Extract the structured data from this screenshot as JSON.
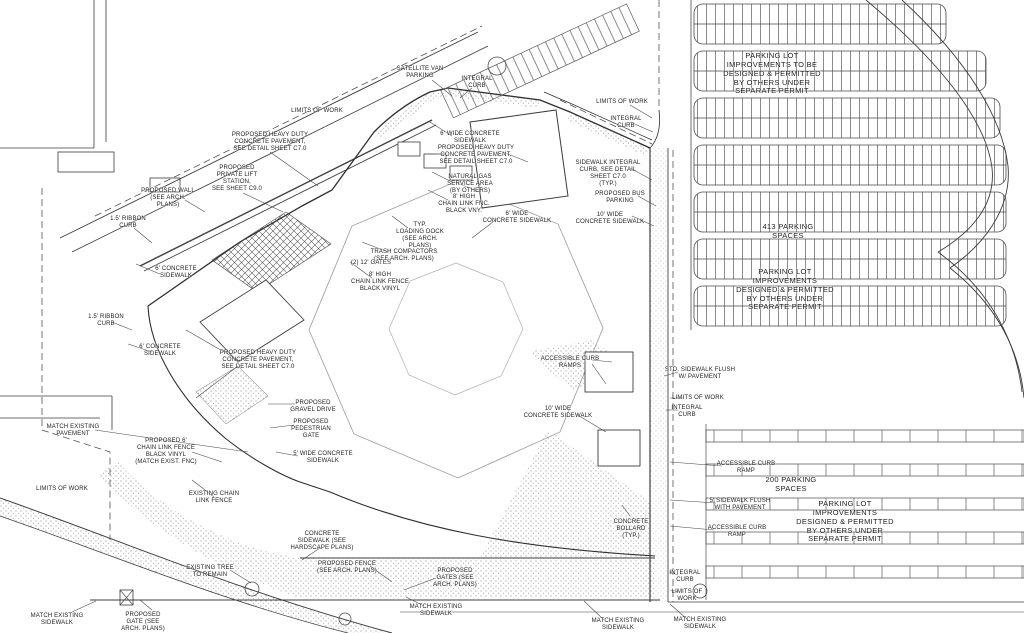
{
  "meta": {
    "drawing_type": "Civil engineering site plan (scanned line drawing)",
    "ink_color": "#2e2e2e",
    "paper_color": "#ffffff"
  },
  "parking": {
    "north_lot_spaces": "413 PARKING SPACES",
    "south_lot_spaces": "200 PARKING SPACES"
  },
  "labels": [
    {
      "id": "limits-of-work-top",
      "text": "LIMITS OF WORK"
    },
    {
      "id": "heavy-duty-pavement-1",
      "text": "PROPOSED HEAVY DUTY\nCONCRETE PAVEMENT,\nSEE DETAIL SHEET C7.0"
    },
    {
      "id": "private-lift-station",
      "text": "PROPOSED\nPRIVATE LIFT\nSTATION,\nSEE SHEET C9.0"
    },
    {
      "id": "proposed-wall",
      "text": "PROPOSED WALL\n(SEE ARCH.\nPLANS)"
    },
    {
      "id": "ribbon-curb-1",
      "text": "1.5' RIBBON\nCURB"
    },
    {
      "id": "concrete-sidewalk-1",
      "text": "6' CONCRETE\nSIDEWALK"
    },
    {
      "id": "ribbon-curb-2",
      "text": "1.5' RIBBON\nCURB"
    },
    {
      "id": "concrete-sidewalk-2",
      "text": "6' CONCRETE\nSIDEWALK"
    },
    {
      "id": "heavy-duty-pavement-2",
      "text": "PROPOSED HEAVY DUTY\nCONCRETE PAVEMENT,\nSEE DETAIL SHEET C7.0"
    },
    {
      "id": "match-existing-pavement",
      "text": "MATCH EXISTING\nPAVEMENT"
    },
    {
      "id": "limits-of-work-left",
      "text": "LIMITS OF WORK"
    },
    {
      "id": "chain-link-fence-6ft",
      "text": "PROPOSED 6'\nCHAIN LINK FENCE\nBLACK VINYL\n(MATCH EXIST. FNC)"
    },
    {
      "id": "existing-chain-link",
      "text": "EXISTING CHAIN\nLINK FENCE"
    },
    {
      "id": "gravel-drive",
      "text": "PROPOSED\nGRAVEL DRIVE"
    },
    {
      "id": "pedestrian-gate",
      "text": "PROPOSED\nPEDESTRIAN\nGATE"
    },
    {
      "id": "sidewalk-5-wide",
      "text": "5' WIDE CONCRETE\nSIDEWALK"
    },
    {
      "id": "existing-tree",
      "text": "EXISTING TREE\nTO REMAIN"
    },
    {
      "id": "match-existing-sidewalk-sw",
      "text": "MATCH EXISTING\nSIDEWALK"
    },
    {
      "id": "proposed-gate-sw",
      "text": "PROPOSED\nGATE (SEE\nARCH. PLANS)"
    },
    {
      "id": "concrete-sidewalk-hardscape",
      "text": "CONCRETE\nSIDEWALK (SEE\nHARDSCAPE PLANS)"
    },
    {
      "id": "proposed-fence",
      "text": "PROPOSED FENCE\n(SEE ARCH. PLANS)"
    },
    {
      "id": "proposed-gates",
      "text": "PROPOSED\nGATES (SEE\nARCH. PLANS)"
    },
    {
      "id": "match-existing-sidewalk-s1",
      "text": "MATCH EXISTING\nSIDEWALK"
    },
    {
      "id": "match-existing-sidewalk-s2",
      "text": "MATCH EXISTING\nSIDEWALK"
    },
    {
      "id": "match-existing-sidewalk-s3",
      "text": "MATCH EXISTING\nSIDEWALK"
    },
    {
      "id": "integral-curb-s",
      "text": "INTEGRAL\nCURB"
    },
    {
      "id": "limits-of-work-s",
      "text": "LIMITS OF\nWORK"
    },
    {
      "id": "satellite-van-parking",
      "text": "SATELLITE VAN\nPARKING"
    },
    {
      "id": "integral-curb-top",
      "text": "INTEGRAL\nCURB"
    },
    {
      "id": "limits-of-work-ne",
      "text": "LIMITS OF WORK"
    },
    {
      "id": "integral-curb-ne",
      "text": "INTEGRAL\nCURB"
    },
    {
      "id": "sidewalk-6-wide-n",
      "text": "6' WIDE CONCRETE\nSIDEWALK"
    },
    {
      "id": "heavy-duty-pavement-3",
      "text": "PROPOSED HEAVY DUTY\nCONCRETE PAVEMENT,\nSEE DETAIL SHEET C7.0"
    },
    {
      "id": "natural-gas-area",
      "text": "NATURAL GAS\nSERVICE AREA\n(BY OTHERS)"
    },
    {
      "id": "chain-link-8-n",
      "text": "8' HIGH\nCHAIN LINK FNC.\nBLACK VNY."
    },
    {
      "id": "sidewalk-6-wide-e",
      "text": "6' WIDE\nCONCRETE SIDEWALK"
    },
    {
      "id": "loading-dock",
      "text": "TYP.\nLOADING DOCK\n(SEE ARCH.\nPLANS)"
    },
    {
      "id": "trash-compactors",
      "text": "TRASH COMPACTORS\n(SEE ARCH. PLANS)"
    },
    {
      "id": "gates-12ft",
      "text": "(2) 12' GATES"
    },
    {
      "id": "chain-link-8-w",
      "text": "8' HIGH\nCHAIN LINK FENCE\nBLACK VINYL"
    },
    {
      "id": "sidewalk-integral-curb",
      "text": "SIDEWALK INTEGRAL\nCURB, SEE DETAIL\nSHEET C7.0\n(TYP.)"
    },
    {
      "id": "bus-parking",
      "text": "PROPOSED BUS\nPARKING"
    },
    {
      "id": "sidewalk-10-ne",
      "text": "10' WIDE\nCONCRETE SIDEWALK"
    },
    {
      "id": "accessible-curb-ramps",
      "text": "ACCESSIBLE CURB\nRAMPS"
    },
    {
      "id": "sidewalk-flush-e",
      "text": "STD. SIDEWALK FLUSH\nW/ PAVEMENT"
    },
    {
      "id": "limits-of-work-e",
      "text": "LIMITS OF WORK"
    },
    {
      "id": "integral-curb-e",
      "text": "INTEGRAL\nCURB"
    },
    {
      "id": "sidewalk-10-c",
      "text": "10' WIDE\nCONCRETE SIDEWALK"
    },
    {
      "id": "accessible-curb-ramp-e1",
      "text": "ACCESSIBLE CURB\nRAMP"
    },
    {
      "id": "sidewalk-flush-se",
      "text": "5' SIDEWALK FLUSH\nWITH PAVEMENT"
    },
    {
      "id": "accessible-curb-ramp-e2",
      "text": "ACCESSIBLE CURB\nRAMP"
    },
    {
      "id": "concrete-bollard",
      "text": "CONCRETE\nBOLLARD\n(TYP.)"
    },
    {
      "id": "south-lot-spaces",
      "text": "200 PARKING\nSPACES"
    },
    {
      "id": "south-lot-note",
      "text": "PARKING LOT\nIMPROVEMENTS\nDESIGNED & PERMITTED\nBY OTHERS UNDER\nSEPARATE PERMIT"
    },
    {
      "id": "north-lot-note",
      "text": "PARKING LOT\nIMPROVEMENTS TO BE\nDESIGNED & PERMITTED\nBY OTHERS UNDER\nSEPARATE PERMIT"
    },
    {
      "id": "north-lot-spaces",
      "text": "413 PARKING\nSPACES"
    },
    {
      "id": "north-lot-note-2",
      "text": "PARKING LOT\nIMPROVEMENTS\nDESIGNED & PERMITTED\nBY OTHERS UNDER\nSEPARATE PERMIT"
    }
  ]
}
